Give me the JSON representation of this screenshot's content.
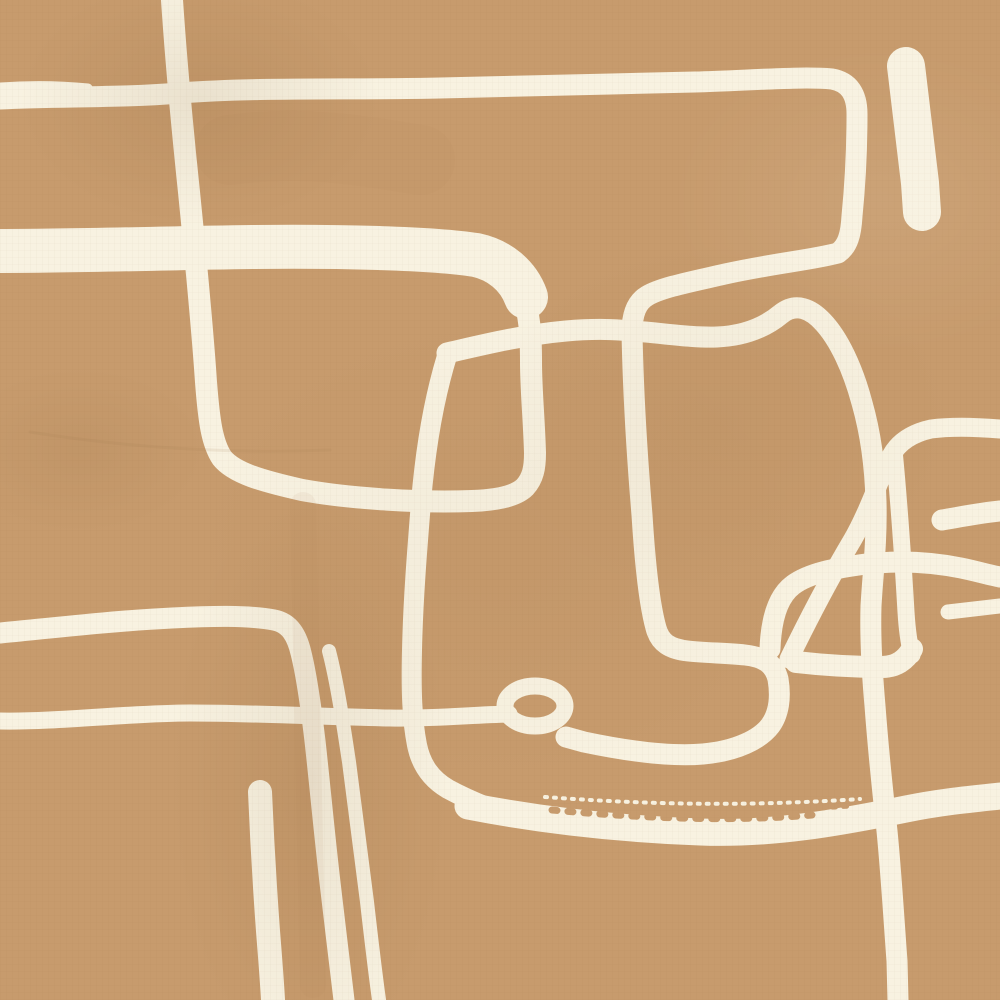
{
  "artwork": {
    "title": "abstract-line-painting",
    "canvas": {
      "width": 1000,
      "height": 1000
    },
    "palette": {
      "background": "#C79B6D",
      "line": "#F8F2E1",
      "texture": "#A87C4F"
    },
    "strokes": [
      {
        "name": "top-left-thin-streak",
        "d": "M 0,87 C 28,85 58,85 88,88",
        "width": 9
      },
      {
        "name": "main-serpentine-line",
        "d": "M 0,99 C 60,96 120,98 180,93 C 260,87 350,90 440,88 C 530,86 610,84 695,82 C 742,81 800,76 832,79 C 849,82 857,94 857,114 C 857,146 855,186 852,216 C 851,234 848,246 838,253 C 812,260 775,263 725,274 C 695,281 662,287 647,296 C 637,302 632,313 632,332 C 633,385 637,455 642,515 C 645,563 649,603 656,628 C 660,643 670,649 688,651 C 706,653 728,653 745,655 C 763,657 774,663 778,679 C 781,697 779,714 770,726 C 760,739 737,751 703,754 C 668,757 622,750 584,742 L 566,737",
        "width": 21
      },
      {
        "name": "loop-ring",
        "type": "ellipse",
        "cx": 535,
        "cy": 706,
        "rx": 30,
        "ry": 20,
        "width": 17
      },
      {
        "name": "loop-tail-left-line",
        "d": "M 509,714 C 470,715 430,719 390,718 C 330,717 255,713 190,713 C 130,713 60,722 0,721",
        "width": 17
      },
      {
        "name": "left-vertical-hook-line",
        "d": "M 172,0 C 176,60 182,125 189,192 C 195,252 202,322 206,382 C 209,421 212,443 222,458 C 234,473 262,481 302,490 C 352,499 422,503 472,501 C 497,500 516,496 525,487 C 533,478 535,468 535,453 C 534,418 531,390 531,362 C 531,332 529,312 523,297 C 518,284 508,271 490,262",
        "width": 22
      },
      {
        "name": "thick-upper-band",
        "d": "M 0,251 C 80,251 170,248 252,247 C 335,246 432,248 476,255 C 499,260 518,275 526,297",
        "width": 44
      },
      {
        "name": "square-left-edge",
        "d": "M 447,356 C 436,392 426,442 421,502 C 417,552 413,602 412,650 C 411,690 412,720 417,745 C 421,765 431,779 448,789 C 459,795 472,801 487,807",
        "width": 20
      },
      {
        "name": "scribble-band",
        "d": "M 468,806 C 540,820 620,829 700,832 C 772,835 842,822 906,809 C 940,802 972,799 1000,796",
        "width": 27
      },
      {
        "name": "square-top-and-right-arc",
        "d": "M 447,353 C 482,345 522,335 566,331 C 600,328 620,330 633,331 C 662,333 692,338 717,337 C 741,336 763,329 781,314 C 796,302 811,309 823,322 C 839,339 853,369 862,403 C 870,431 875,462 876,502 C 877,541 873,572 871,606 C 870,641 872,672 875,706 C 878,746 882,786 887,831 C 891,871 894,921 897,961 L 898,1000",
        "width": 21
      },
      {
        "name": "lower-left-band-corner-line",
        "d": "M 0,633 C 52,628 112,621 172,618 C 212,616 247,615 274,620 C 290,623 297,636 301,653 C 307,677 311,707 315,741 C 320,786 325,841 331,891 C 335,926 340,966 344,1000",
        "width": 21
      },
      {
        "name": "lower-left-diagonal-line",
        "d": "M 329,651 C 337,682 343,722 349,762 C 354,802 361,852 367,902 C 371,937 375,971 379,1000",
        "width": 14
      },
      {
        "name": "short-bottom-vertical-bar",
        "d": "M 260,792 C 262,840 265,890 268,931 C 270,956 272,981 273,1000",
        "width": 24
      },
      {
        "name": "top-right-thick-bar",
        "d": "M 906,66 C 911,110 916,150 920,183 L 922,212",
        "width": 38
      },
      {
        "name": "right-hockey-curve",
        "d": "M 789,659 C 806,624 831,576 853,539 C 869,511 879,479 891,456 C 899,441 913,433 931,429 C 953,426 976,427 1000,429",
        "width": 19
      },
      {
        "name": "right-mid-band",
        "d": "M 770,649 C 771,621 777,597 793,585 C 809,573 836,568 866,564 C 901,560 931,562 961,568 C 976,571 989,575 1000,577",
        "width": 21
      },
      {
        "name": "right-tail-bar",
        "d": "M 796,662 C 822,665 852,667 882,667 C 896,667 906,660 912,649",
        "width": 22
      },
      {
        "name": "right-short-connector",
        "d": "M 894,450 C 899,502 903,560 906,612 C 907,628 909,644 912,655",
        "width": 17
      },
      {
        "name": "right-edge-bar-upper",
        "d": "M 942,520 C 960,517 980,513 1000,511",
        "width": 21
      },
      {
        "name": "right-edge-bar-lower",
        "d": "M 948,612 C 965,610 982,608 1000,606",
        "width": 15
      },
      {
        "name": "scribble-drybrush-tan-1",
        "d": "M 552,810 C 640,818 730,822 812,815",
        "width": 7,
        "dash": "5 11",
        "color": "background"
      },
      {
        "name": "scribble-drybrush-tan-2",
        "d": "M 580,802 C 660,810 750,813 850,806",
        "width": 5,
        "dash": "3 8",
        "color": "background"
      },
      {
        "name": "scribble-spray-cream",
        "d": "M 545,797 C 640,804 740,807 860,799",
        "width": 4,
        "dash": "2 7",
        "color": "line"
      },
      {
        "name": "shadow-streak-vertical",
        "d": "M 303,505 C 305,655 309,805 313,985",
        "width": 26,
        "color": "texture",
        "opacity": 0.07
      },
      {
        "name": "shadow-patch-topleft",
        "d": "M 230,150 C 300,140 360,150 420,160",
        "width": 70,
        "color": "texture",
        "opacity": 0.05
      },
      {
        "name": "shadow-crack-left",
        "d": "M 30,432 C 130,448 230,454 330,450",
        "width": 3,
        "color": "texture",
        "opacity": 0.12
      }
    ]
  }
}
